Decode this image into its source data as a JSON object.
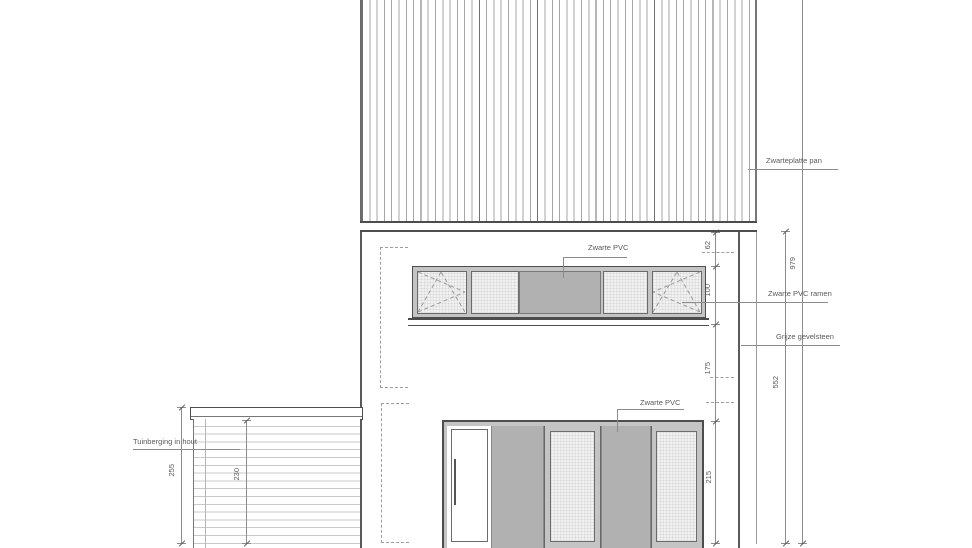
{
  "labels": {
    "roof_material": "Zwarteplatte pan",
    "upper_panel": "Zwarte PVC",
    "windows": "Zwarte PVC ramen",
    "facade": "Grijze gevelsteen",
    "lower_panel": "Zwarte PVC",
    "shed": "Tuinberging in hout"
  },
  "dimensions": {
    "seg_62": "62",
    "seg_100": "100",
    "seg_175": "175",
    "seg_215": "215",
    "total_979": "979",
    "total_552": "552",
    "shed_255": "255",
    "shed_230": "230"
  },
  "colors": {
    "line_dark": "#4d4d4d",
    "line_mid": "#8c8c8c",
    "panel_gray": "#b1b1b1",
    "frame_gray": "#c4c4c4",
    "glass_light": "#f1f1f1",
    "text": "#5a5a5a"
  }
}
